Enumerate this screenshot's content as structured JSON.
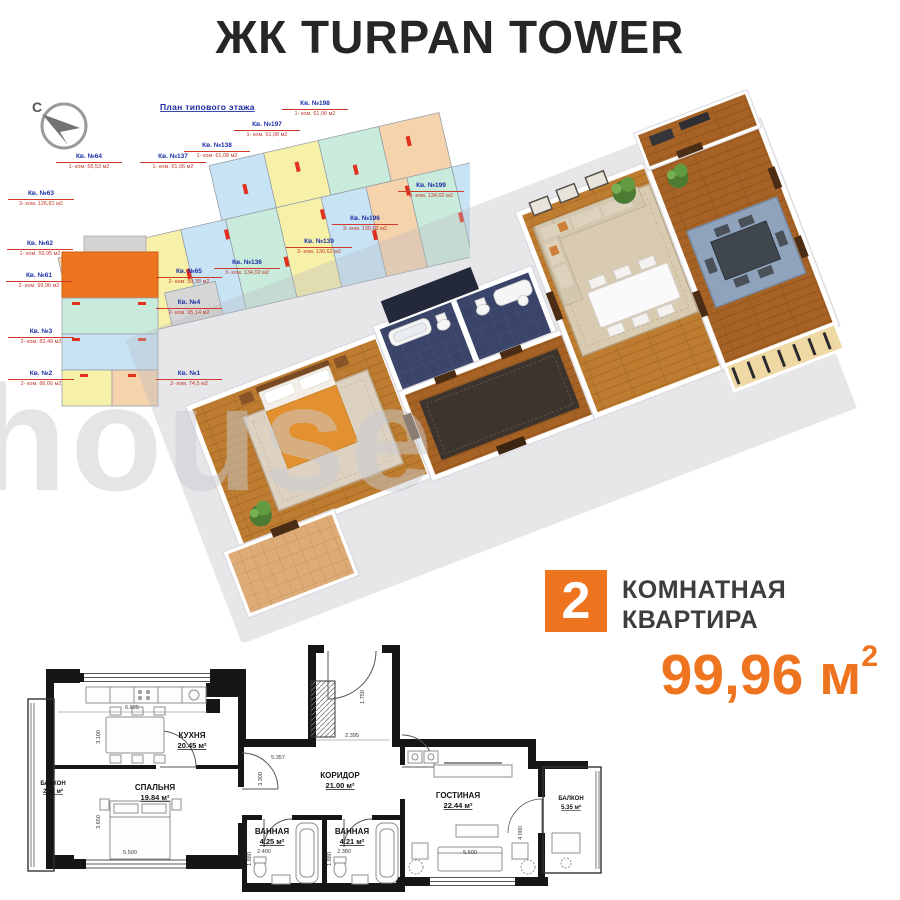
{
  "page": {
    "title": "ЖК TURPAN TOWER",
    "watermark": "house"
  },
  "colors": {
    "accent": "#EE7420",
    "title_dark": "#262626",
    "label_blue": "#1D2FA8",
    "label_red": "#C03A2A",
    "plan_wall_black": "#161616",
    "overview_peach": "#F5D3AC",
    "overview_yellow": "#F7F0A8",
    "overview_blue": "#C7E3F4",
    "overview_teal": "#C9EBDB"
  },
  "overview": {
    "title": "План типового этажа",
    "compass_label": "С",
    "apartments": [
      {
        "name": "Кв. №64",
        "info": "1- ком. 56,53 м2",
        "highlighted": false
      },
      {
        "name": "Кв. №137",
        "info": "1- ком. 61,06 м2",
        "highlighted": false
      },
      {
        "name": "Кв. №138",
        "info": "1- ком. 61,08 м2",
        "highlighted": false
      },
      {
        "name": "Кв. №197",
        "info": "1- ком. 61,08 м2",
        "highlighted": false
      },
      {
        "name": "Кв. №198",
        "info": "1- ком. 61,06 м2",
        "highlighted": false
      },
      {
        "name": "Кв. №199",
        "info": "3- ком. 134,02 м2",
        "highlighted": false
      },
      {
        "name": "Кв. №196",
        "info": "3- ком. 130,62 м2",
        "highlighted": false
      },
      {
        "name": "Кв. №139",
        "info": "3- ком. 130,62 м2",
        "highlighted": false
      },
      {
        "name": "Кв. №136",
        "info": "3- ком. 134,02 м2",
        "highlighted": false
      },
      {
        "name": "Кв. №65",
        "info": "2- ком. 99,38 м2",
        "highlighted": false
      },
      {
        "name": "Кв. №63",
        "info": "3- ком. 126,81 м2",
        "highlighted": false
      },
      {
        "name": "Кв. №62",
        "info": "1- ком. 59,95 м2",
        "highlighted": false
      },
      {
        "name": "Кв. №61",
        "info": "2- ком. 99,96 м2",
        "highlighted": true
      },
      {
        "name": "Кв. №4",
        "info": "2- ком. 95,14 м2",
        "highlighted": false
      },
      {
        "name": "Кв. №3",
        "info": "2- ком. 83,49 м2",
        "highlighted": false
      },
      {
        "name": "Кв. №2",
        "info": "2- ком. 86,66 м2",
        "highlighted": false
      },
      {
        "name": "Кв. №1",
        "info": "2- ком. 74,5 м2",
        "highlighted": false
      }
    ]
  },
  "apartment_badge": {
    "rooms": "2",
    "line1": "КОМНАТНАЯ",
    "line2": "КВАРТИРА",
    "area_value": "99,96 м",
    "area_sup": "2"
  },
  "plan2d": {
    "rooms": [
      {
        "name": "БАЛКОН",
        "area": "2.42 м²"
      },
      {
        "name": "КУХНЯ",
        "area": "20.45 м²"
      },
      {
        "name": "СПАЛЬНЯ",
        "area": "19.84 м²"
      },
      {
        "name": "КОРИДОР",
        "area": "21.00 м²"
      },
      {
        "name": "ВАННАЯ",
        "area": "4.25 м²"
      },
      {
        "name": "ВАННАЯ",
        "area": "4.21 м²"
      },
      {
        "name": "ГОСТИНАЯ",
        "area": "22.44 м²"
      },
      {
        "name": "БАЛКОН",
        "area": "5.35 м²"
      }
    ],
    "dims": {
      "kitchen_w": "6.825",
      "kitchen_h": "3.100",
      "bedroom_h": "3.650",
      "bedroom_w": "5.500",
      "entry_w": "2.395",
      "entry_h": "1.750",
      "corridor_w": "5.357",
      "corridor_h": "3.300",
      "bath1_w": "2.400",
      "bath2_w": "2.380",
      "bath1_h": "1.880",
      "bath2_h": "1.880",
      "living_w": "5.500",
      "living_h": "4.000"
    }
  }
}
